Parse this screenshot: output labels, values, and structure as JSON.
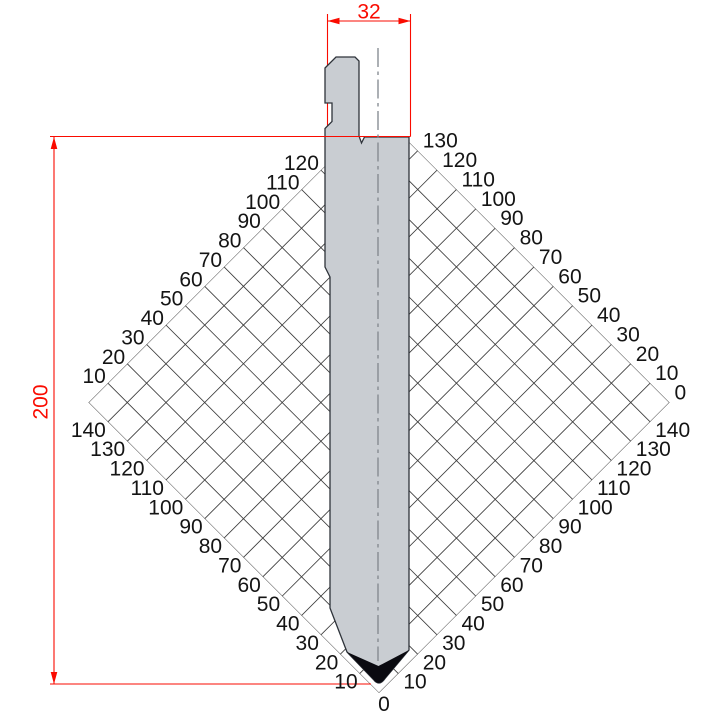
{
  "drawing": {
    "type": "press-brake-punch-technical-drawing",
    "dimension_width_mm": "32",
    "dimension_height_mm": "200",
    "scale_labels": {
      "upper_left": [
        10,
        20,
        30,
        40,
        50,
        60,
        70,
        80,
        90,
        100,
        110,
        120
      ],
      "upper_right": [
        0,
        10,
        20,
        30,
        40,
        50,
        60,
        70,
        80,
        90,
        100,
        110,
        120,
        130
      ],
      "lower_left": [
        10,
        20,
        30,
        40,
        50,
        60,
        70,
        80,
        90,
        100,
        110,
        120,
        130,
        140
      ],
      "lower_right": [
        10,
        20,
        30,
        40,
        50,
        60,
        70,
        80,
        90,
        100,
        110,
        120,
        130,
        140
      ],
      "bottom_origin": "0"
    },
    "colors": {
      "dimension_red": "#fa0b00",
      "punch_fill": "#c9cdd2",
      "punch_outline": "#2e333a",
      "grid_line": "#3c3c3c",
      "tip_black": "#0a0a10",
      "centerline_gray": "#80868d",
      "label_black": "#141414",
      "background": "#ffffff"
    }
  }
}
